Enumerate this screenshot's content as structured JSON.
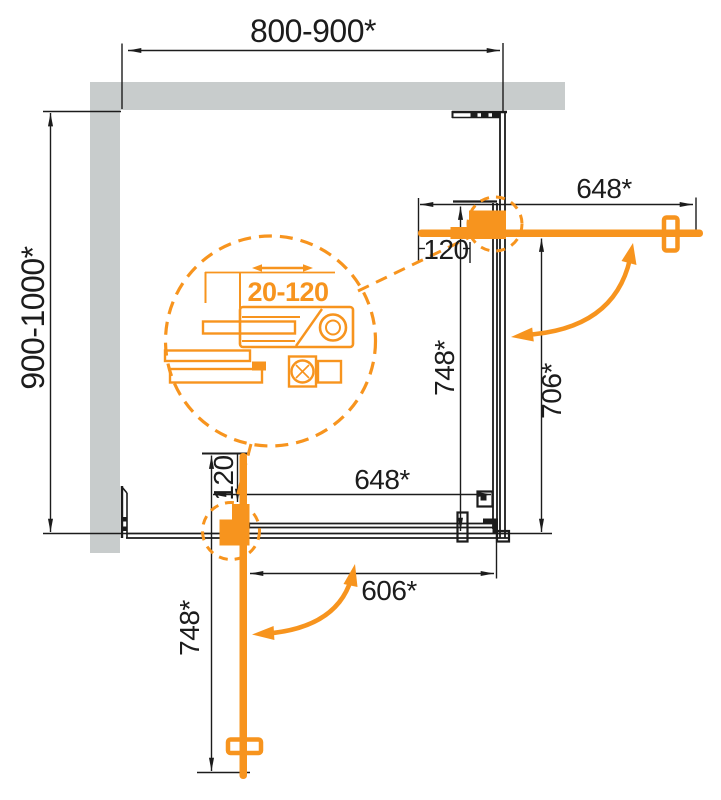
{
  "diagram": {
    "type": "shower-enclosure-installation-plan",
    "colors": {
      "accent_orange": "#F7941E",
      "wall_gray": "#c8cccc",
      "line_black": "#1c1c1c"
    },
    "labels": {
      "width_top": "800-900*",
      "depth_left": "900-1000*",
      "door_top_width": "648*",
      "hinge_offset_top": "120",
      "panel_right_height": "748*",
      "opening_right": "706*",
      "panel_bottom_width": "648*",
      "hinge_offset_bottom": "120",
      "opening_bottom": "606*",
      "door_bottom_height": "748*",
      "adjustment_range": "20-120"
    }
  }
}
